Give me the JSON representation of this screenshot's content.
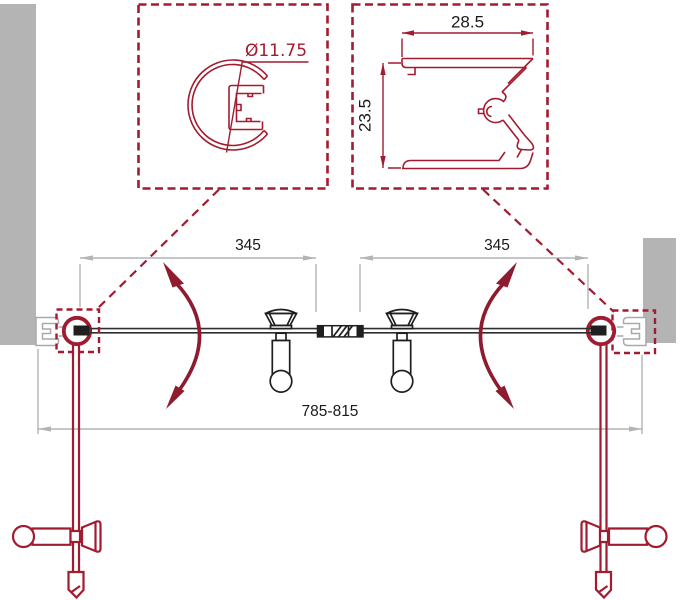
{
  "diagram": {
    "title": "shower-door-technical-drawing",
    "detail_hinge_profile": {
      "diameter_label": "Ø11.75"
    },
    "detail_wall_profile": {
      "width_label": "28.5",
      "height_label": "23.5"
    },
    "plan_view": {
      "left_door_width_label": "345",
      "right_door_width_label": "345",
      "overall_width_label": "785-815"
    },
    "colors": {
      "profile_red": "#a11c30",
      "swing_arrow_red": "#8e1b2e",
      "dimension_gray": "#b3b3b3",
      "wall_gray": "#b4b4b4",
      "drawing_ink": "#1f1f1f",
      "text_black": "#1a1a1a"
    }
  }
}
